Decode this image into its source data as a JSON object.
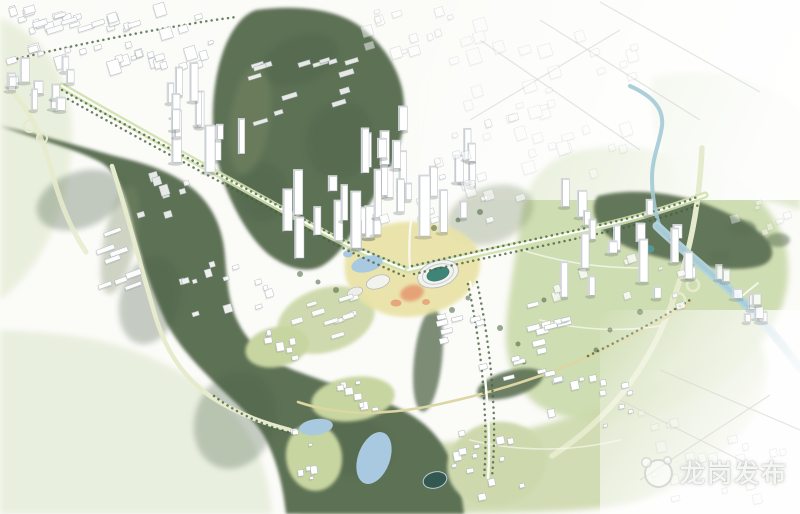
{
  "image": {
    "type": "aerial-masterplan-rendering",
    "description": "Bird's-eye watercolor-style master plan rendering of an urban district: forested dark-green hills, white high-rise clusters along tree-lined axes, a central stadium and civic complex with lakes, a winding river on the east, highways with interchanges, and faded sketchy city fabric at the edges"
  },
  "watermark": {
    "text": "龙岗发布",
    "logo": "panda-badge-icon"
  },
  "palette": {
    "bg": "#fbfbf8",
    "wash_left": "#e7eed9",
    "wash_corner": "#e9efdf",
    "hill_dark": "#5d7154",
    "hill_mid": "#7c8c66",
    "hill_clump": "#4c6146",
    "field_east": "#cbdaab",
    "field_ne": "#d9e4c4",
    "field_bottom": "#cdd9ad",
    "terrace": "#c7d5a0",
    "civic_yellow": "#e9e3a6",
    "plaza_orange": "#e69b72",
    "stadium_green": "#3f8577",
    "stadium_roof": "#f3f3ee",
    "river": "#a3cad6",
    "river_wide": "#b5d5dd",
    "lake": "#a9c9e0",
    "pond_dark": "#33584f",
    "pond_teal": "#55989a",
    "road_white": "#fbfbf7",
    "road_pale": "#e7ebcd",
    "road_cream": "#dcd6a2",
    "road_median": "#cfe0ac",
    "tree": "#47613f",
    "building_fill": "#ffffff",
    "building_side": "#d3d7db",
    "building_stroke": "#b2b8be",
    "building_shadow": "rgba(105,115,108,0.3)",
    "sketch": "#d6d9d2",
    "watermark_text": "rgba(253,254,251,0.92)"
  },
  "map": {
    "features": [
      "forest-hill-north",
      "forest-hill-west-arc",
      "forest-park-east",
      "fields-east",
      "fields-northeast",
      "fields-bottom",
      "river",
      "stadium",
      "civic-lake",
      "south-lakes",
      "round-pond",
      "main-axis-boulevard-nw",
      "main-axis-boulevard-ne",
      "west-interchange",
      "east-interchange",
      "viaduct",
      "winding-south-road"
    ],
    "clusters": [
      {
        "name": "topleft-grid",
        "x": 112,
        "y": 38,
        "w": 215,
        "h": 60,
        "rot": -17,
        "n": 46,
        "kind": "block",
        "smin": 5,
        "smax": 12,
        "op": 0.95
      },
      {
        "name": "topleft-sheds",
        "x": 95,
        "y": 20,
        "w": 130,
        "h": 26,
        "rot": -17,
        "n": 9,
        "kind": "slab",
        "smin": 10,
        "smax": 17,
        "op": 0.9
      },
      {
        "name": "topleft-towers",
        "x": 38,
        "y": 86,
        "w": 62,
        "h": 54,
        "rot": 0,
        "n": 11,
        "kind": "tower",
        "hmin": 8,
        "hmax": 24,
        "op": 0.95
      },
      {
        "name": "topmid-blocks",
        "x": 408,
        "y": 34,
        "w": 85,
        "h": 58,
        "rot": -17,
        "n": 14,
        "kind": "block",
        "smin": 5,
        "smax": 11,
        "op": 0.5
      },
      {
        "name": "topright-fabric",
        "x": 545,
        "y": 100,
        "w": 185,
        "h": 150,
        "rot": -17,
        "n": 40,
        "kind": "block",
        "smin": 6,
        "smax": 13,
        "op": 0.32
      },
      {
        "name": "nw-towers",
        "x": 204,
        "y": 130,
        "w": 72,
        "h": 92,
        "rot": 0,
        "n": 12,
        "kind": "tower",
        "hmin": 14,
        "hmax": 40,
        "op": 1
      },
      {
        "name": "nw-slabs",
        "x": 300,
        "y": 92,
        "w": 112,
        "h": 66,
        "rot": -17,
        "n": 15,
        "kind": "slab",
        "smin": 8,
        "smax": 16,
        "op": 0.85
      },
      {
        "name": "axis-towers",
        "x": 336,
        "y": 206,
        "w": 104,
        "h": 96,
        "rot": 0,
        "n": 15,
        "kind": "tower",
        "hmin": 14,
        "hmax": 46,
        "op": 1
      },
      {
        "name": "central-towers",
        "x": 420,
        "y": 182,
        "w": 100,
        "h": 108,
        "rot": 0,
        "n": 16,
        "kind": "tower",
        "hmin": 14,
        "hmax": 48,
        "op": 1
      },
      {
        "name": "central-podiums",
        "x": 432,
        "y": 196,
        "w": 116,
        "h": 52,
        "rot": -17,
        "n": 11,
        "kind": "block",
        "smin": 4,
        "smax": 9,
        "op": 0.8
      },
      {
        "name": "central-east-blocks",
        "x": 478,
        "y": 158,
        "w": 85,
        "h": 85,
        "rot": -17,
        "n": 14,
        "kind": "block",
        "smin": 5,
        "smax": 10,
        "op": 0.55
      },
      {
        "name": "east-towers",
        "x": 625,
        "y": 248,
        "w": 130,
        "h": 105,
        "rot": 0,
        "n": 15,
        "kind": "tower",
        "hmin": 10,
        "hmax": 36,
        "op": 1
      },
      {
        "name": "east-podiums",
        "x": 618,
        "y": 276,
        "w": 128,
        "h": 64,
        "rot": -17,
        "n": 10,
        "kind": "block",
        "smin": 4,
        "smax": 9,
        "op": 0.75
      },
      {
        "name": "fareast-small-towers",
        "x": 737,
        "y": 300,
        "w": 58,
        "h": 52,
        "rot": 0,
        "n": 8,
        "kind": "tower",
        "hmin": 6,
        "hmax": 15,
        "op": 0.85
      },
      {
        "name": "fareast-faded",
        "x": 760,
        "y": 213,
        "w": 70,
        "h": 42,
        "rot": -17,
        "n": 7,
        "kind": "block",
        "smin": 5,
        "smax": 9,
        "op": 0.4
      },
      {
        "name": "west-industrial",
        "x": 118,
        "y": 264,
        "w": 52,
        "h": 72,
        "rot": -20,
        "n": 8,
        "kind": "slab",
        "smin": 12,
        "smax": 19,
        "op": 0.95
      },
      {
        "name": "midwest-blocks",
        "x": 160,
        "y": 198,
        "w": 58,
        "h": 50,
        "rot": -17,
        "n": 8,
        "kind": "block",
        "smin": 5,
        "smax": 9,
        "op": 0.85
      },
      {
        "name": "south-central-blocks",
        "x": 228,
        "y": 298,
        "w": 92,
        "h": 76,
        "rot": -17,
        "n": 13,
        "kind": "block",
        "smin": 4,
        "smax": 9,
        "op": 0.9
      },
      {
        "name": "stadium-south-slabs",
        "x": 325,
        "y": 318,
        "w": 82,
        "h": 52,
        "rot": -17,
        "n": 10,
        "kind": "slab",
        "smin": 9,
        "smax": 15,
        "op": 0.92
      },
      {
        "name": "se-slabs-a",
        "x": 462,
        "y": 338,
        "w": 48,
        "h": 58,
        "rot": -14,
        "n": 8,
        "kind": "slab",
        "smin": 8,
        "smax": 14,
        "op": 1
      },
      {
        "name": "se-slabs-b",
        "x": 557,
        "y": 320,
        "w": 60,
        "h": 50,
        "rot": -14,
        "n": 9,
        "kind": "slab",
        "smin": 9,
        "smax": 15,
        "op": 1
      },
      {
        "name": "se-slabs-c",
        "x": 532,
        "y": 366,
        "w": 56,
        "h": 42,
        "rot": -14,
        "n": 8,
        "kind": "slab",
        "smin": 8,
        "smax": 13,
        "op": 1
      },
      {
        "name": "campus-west",
        "x": 274,
        "y": 346,
        "w": 50,
        "h": 30,
        "rot": -10,
        "n": 7,
        "kind": "block",
        "smin": 4,
        "smax": 8,
        "op": 1
      },
      {
        "name": "campus-south",
        "x": 352,
        "y": 398,
        "w": 66,
        "h": 32,
        "rot": -8,
        "n": 8,
        "kind": "block",
        "smin": 4,
        "smax": 8,
        "op": 1
      },
      {
        "name": "lakeside-blocks",
        "x": 310,
        "y": 456,
        "w": 40,
        "h": 50,
        "rot": -8,
        "n": 7,
        "kind": "block",
        "smin": 3.5,
        "smax": 7,
        "op": 1
      },
      {
        "name": "southeast-campus",
        "x": 495,
        "y": 463,
        "w": 82,
        "h": 70,
        "rot": -12,
        "n": 13,
        "kind": "block",
        "smin": 4,
        "smax": 8,
        "op": 1
      },
      {
        "name": "south-blocks",
        "x": 592,
        "y": 400,
        "w": 88,
        "h": 52,
        "rot": -12,
        "n": 11,
        "kind": "block",
        "smin": 4,
        "smax": 8,
        "op": 1
      },
      {
        "name": "bottomright-sketch",
        "x": 700,
        "y": 458,
        "w": 170,
        "h": 95,
        "rot": -12,
        "n": 20,
        "kind": "block",
        "smin": 5,
        "smax": 10,
        "op": 0.3
      }
    ],
    "landmark_towers": [
      {
        "x": 352,
        "y": 248,
        "w": 9,
        "h": 56
      },
      {
        "x": 420,
        "y": 236,
        "w": 10,
        "h": 60
      },
      {
        "x": 206,
        "y": 172,
        "w": 9,
        "h": 46
      },
      {
        "x": 296,
        "y": 258,
        "w": 8,
        "h": 40
      },
      {
        "x": 640,
        "y": 282,
        "w": 8,
        "h": 42
      },
      {
        "x": 582,
        "y": 268,
        "w": 7,
        "h": 34
      }
    ]
  }
}
